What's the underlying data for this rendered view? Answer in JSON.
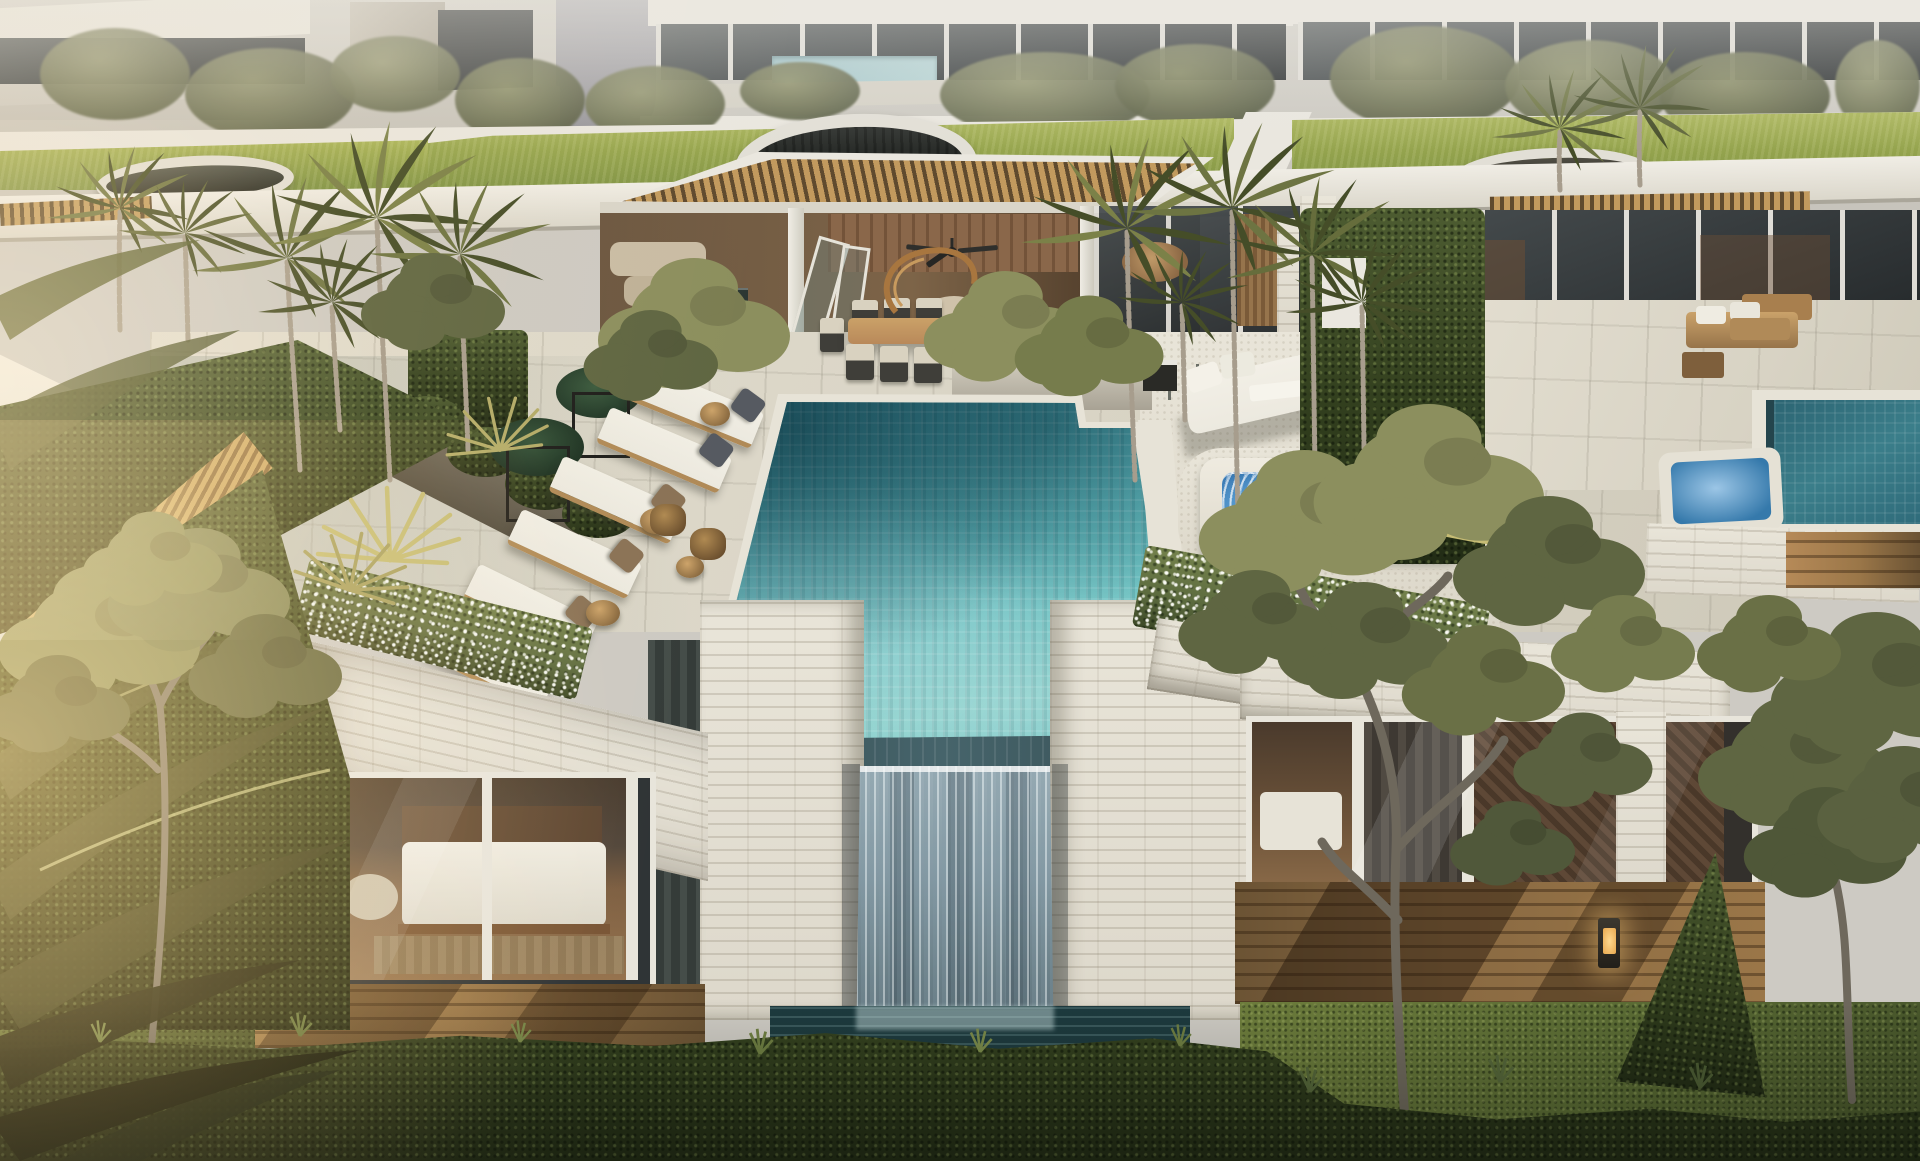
{
  "meta": {
    "description": "Aerial architectural rendering of a modern tropical luxury villa rooftop terrace at golden hour",
    "width_px": 1920,
    "height_px": 1161
  },
  "palette": {
    "bg-base": "#cdcac3",
    "bg-glass": "#3f4448",
    "wall-white": "#eae7df",
    "stone-light": "#ddd8cb",
    "stone-line": "#b5ad9c",
    "ramp-gray": "#a3a2a8",
    "roof-grass-hi": "#a9b457",
    "roof-grass-lo": "#7e9244",
    "perg-hi": "#c29a5e",
    "perg-lo": "#5f4a2e",
    "terrace-warm": "#d8d3c4",
    "terrace-cool": "#b7bbad",
    "pool-dark": "#215a6b",
    "pool-mid": "#4da4ad",
    "pool-light": "#83cdc9",
    "pool-edge": "#3d5a60",
    "coping": "#e7e3d7",
    "waterfall-hi": "#d6e0e2",
    "waterfall-lo": "#5d737d",
    "basin": "#1d3a3e",
    "jacuzzi-hi": "#c3e1f2",
    "jacuzzi-mid": "#5b9fd4",
    "jacuzzi-lo": "#2e6da8",
    "daybed": "#ece9df",
    "pillow-slate": "#565a61",
    "pillow-brown": "#8a7256",
    "wood-furn": "#b9895a",
    "chair-dark": "#3f3e39",
    "cushion": "#d9d2c0",
    "interior-wood": "#8a674a",
    "interior-dark": "#57432f",
    "curtain": "#4d5551",
    "window-frame": "#e8e5db",
    "glass-dark": "#33383a",
    "deck-hi": "#b68a58",
    "deck-lo": "#6b5334",
    "hedge-hi": "#4d5c31",
    "hedge-lo": "#222c15",
    "lawn": "#5a6b34",
    "tree-hi": "#8c8f5e",
    "tree-lo": "#5f6642",
    "trunk": "#7d7668",
    "palm-hi": "#6d7442",
    "palm-lo": "#454d28",
    "palm-trunk": "#a79d8d",
    "fence-hi": "#cda462",
    "fence-lo": "#8a683c",
    "flower-green": "#5b6a3e",
    "bollard-glow": "#ffd98f",
    "flare": "#ffd092"
  },
  "scene": {
    "setting": {
      "label": "aerial three-quarter view of modern villa rooftop at late-afternoon golden hour"
    },
    "background": {
      "label": "neighboring white villas with glass facades, trees and a shared pool"
    },
    "roofs": {
      "label": "planted green grass roofs with circular skylights",
      "skylight_count": 3
    },
    "pavilion": {
      "label": "open-air rooftop pavilion",
      "features": [
        "timber pergola",
        "ceiling fan",
        "spiral staircase",
        "indoor lounge",
        "dining area"
      ]
    },
    "pool": {
      "label": "turquoise mosaic-tiled infinity pool"
    },
    "waterfall": {
      "label": "infinity-edge waterfall cascading down stone facade into lower basin"
    },
    "jacuzzi": {
      "label": "square bubbling hot tub with pebble surround"
    },
    "daybed": {
      "label": "white outdoor daybed with pillows and towel"
    },
    "loungers": {
      "label": "row of cushioned sun loungers with side tables",
      "count": 6,
      "pillow_colors": [
        "slate",
        "slate",
        "brown",
        "brown",
        "brown",
        "brown"
      ]
    },
    "dining": {
      "label": "outdoor wooden dining table",
      "chair_count": 8
    },
    "wicker_chairs": {
      "label": "pair of rattan lounge chairs with side table",
      "count": 2
    },
    "planters": {
      "label": "stone planters with white flowering groundcover"
    },
    "bedroom_left": {
      "label": "lower-floor bedroom behind glass sliding doors"
    },
    "bedroom_right": {
      "label": "second bedroom behind glass sliding doors"
    },
    "deck": {
      "label": "timber deck walkway with garden bollard lights",
      "bollard_count": 2
    },
    "hedge": {
      "label": "dense clipped foreground hedge"
    },
    "fence": {
      "label": "diagonal timber slat privacy fence"
    },
    "palms": {
      "label": "clusters of areca palms and bromeliads"
    },
    "trees": {
      "label": "sculptural garden trees"
    },
    "neighbor": {
      "label": "adjacent villa terrace with timber sofas, pool and spa"
    }
  }
}
